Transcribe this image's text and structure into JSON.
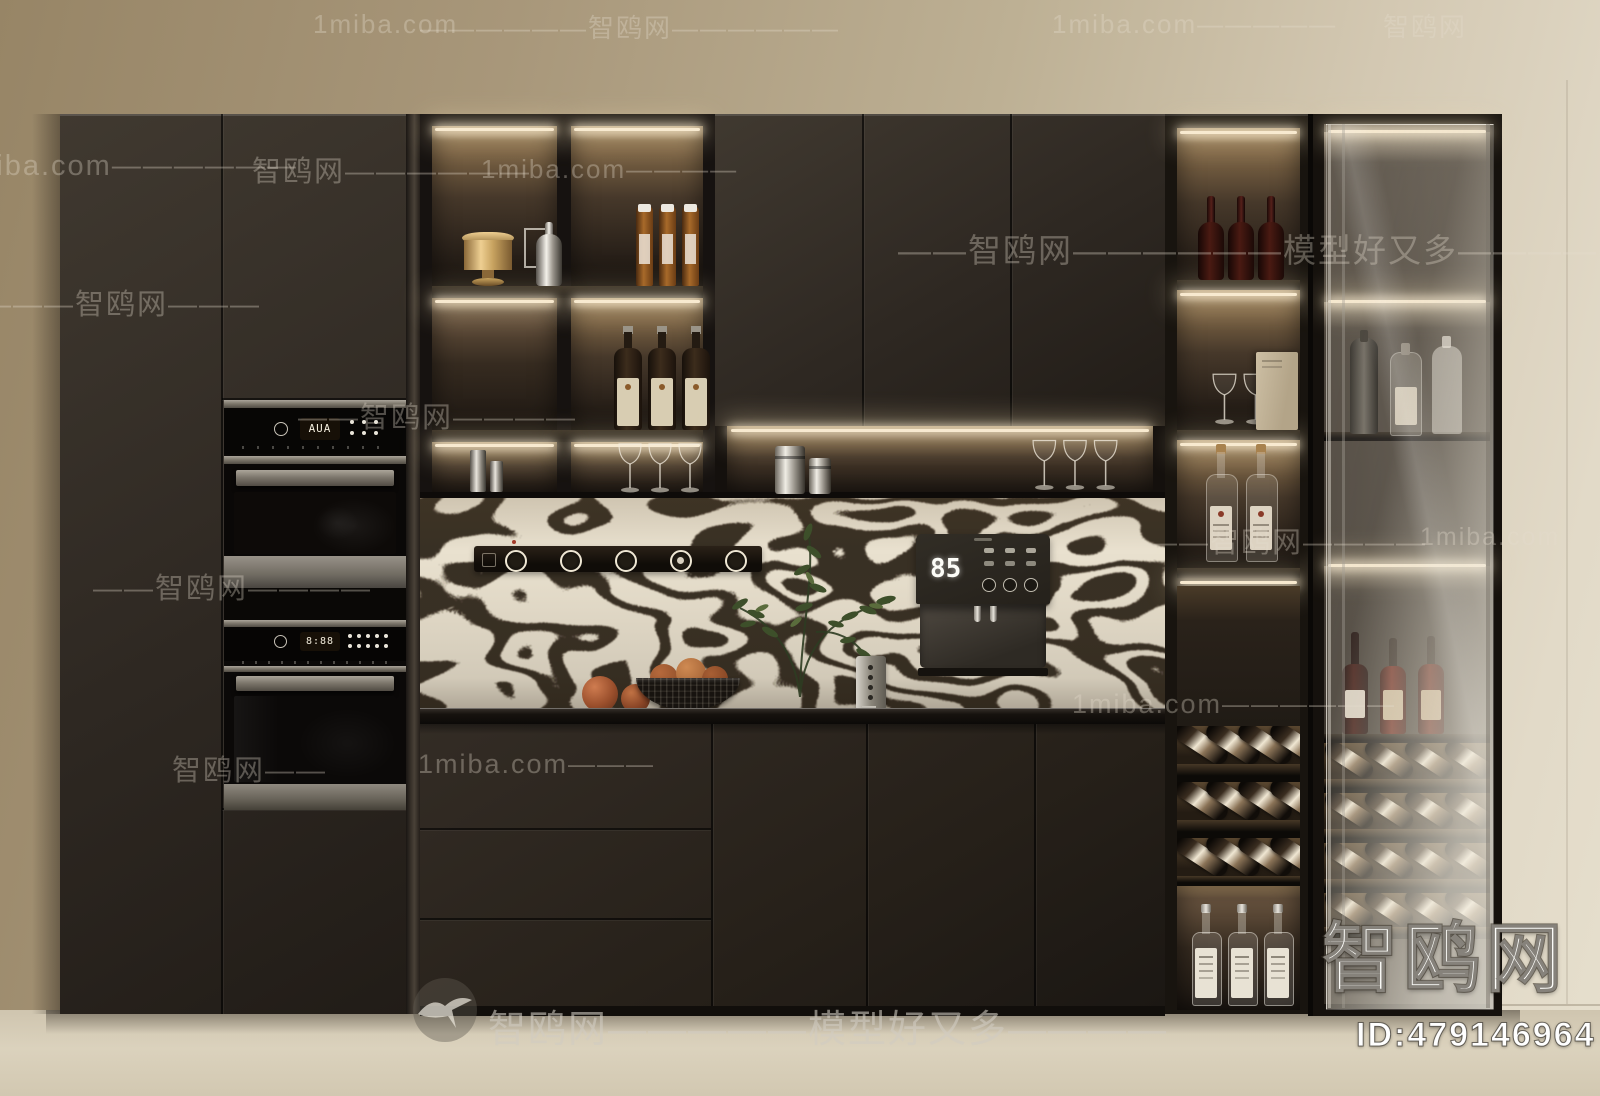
{
  "watermarks": {
    "site_cn": "智鸥网",
    "site_en": "1miba.com",
    "tagline": "模型好又多",
    "corner_logo": "智鸥网",
    "image_id": "ID:479146964",
    "tiles": [
      {
        "text": "1miba.com",
        "x": 313,
        "y": 9,
        "fs": 26
      },
      {
        "text": "——————智鸥网——————",
        "x": 420,
        "y": 8,
        "fs": 26
      },
      {
        "text": "1miba.com—————",
        "x": 1052,
        "y": 9,
        "fs": 26
      },
      {
        "text": "智鸥网",
        "x": 1383,
        "y": 7,
        "fs": 26
      },
      {
        "text": "1miba.com——————",
        "x": -48,
        "y": 150,
        "fs": 29
      },
      {
        "text": "智鸥网——————",
        "x": 252,
        "y": 148,
        "fs": 29
      },
      {
        "text": "1miba.com————",
        "x": 481,
        "y": 154,
        "fs": 26
      },
      {
        "text": "——智鸥网——————模型好又多————",
        "x": 898,
        "y": 224,
        "fs": 33
      },
      {
        "text": "———智鸥网———",
        "x": -18,
        "y": 281,
        "fs": 29
      },
      {
        "text": "——智鸥网————",
        "x": 298,
        "y": 394,
        "fs": 29
      },
      {
        "text": "——智鸥网————",
        "x": 1148,
        "y": 519,
        "fs": 29
      },
      {
        "text": "1miba.com",
        "x": 1420,
        "y": 523,
        "fs": 25
      },
      {
        "text": "——智鸥网————",
        "x": 93,
        "y": 565,
        "fs": 29
      },
      {
        "text": "1miba.com——————",
        "x": 1072,
        "y": 689,
        "fs": 27
      },
      {
        "text": "智鸥网——",
        "x": 172,
        "y": 747,
        "fs": 29
      },
      {
        "text": "1miba.com———",
        "x": 418,
        "y": 749,
        "fs": 27
      },
      {
        "text": "智鸥网—————模型好又多————",
        "x": 488,
        "y": 998,
        "fs": 38,
        "strong": true
      }
    ]
  },
  "appliances": {
    "oven_top_display": "AUA",
    "oven_bottom_display": "8:88",
    "water_dispenser_temp": "85"
  },
  "colors": {
    "wall": "#ab9a7c",
    "cabinet": "#332c26",
    "led": "#f8ead0",
    "backsplash_cream": "#e9e1cf",
    "backsplash_ink": "#2a2014",
    "counter": "#15110d"
  }
}
